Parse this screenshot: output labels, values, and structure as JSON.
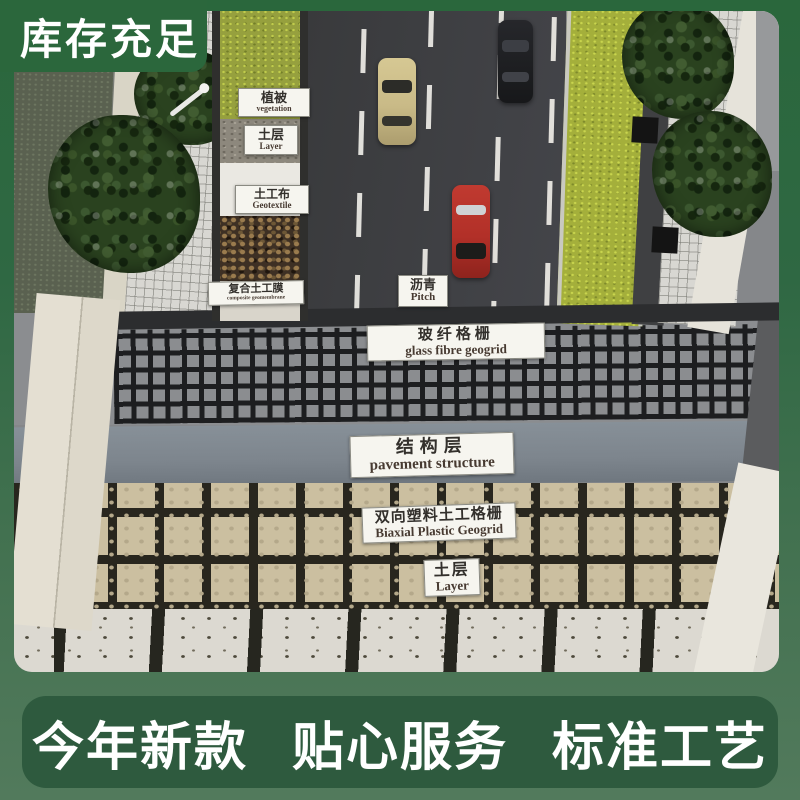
{
  "badge": {
    "label": "库存充足"
  },
  "bottom_banner": {
    "items": [
      "今年新款",
      "贴心服务",
      "标准工艺"
    ]
  },
  "model": {
    "tags": {
      "vegetation": {
        "zh": "植被",
        "en": "vegetation"
      },
      "soil_top": {
        "zh": "土层",
        "en": "Layer"
      },
      "geotextile": {
        "zh": "土工布",
        "en": "Geotextile"
      },
      "geomembrane": {
        "zh": "复合土工膜",
        "en": "composite geomembrane"
      },
      "pitch": {
        "zh": "沥青",
        "en": "Pitch"
      },
      "glass_geogrid": {
        "zh": "玻纤格栅",
        "en": "glass fibre geogrid"
      },
      "structure": {
        "zh": "结构层",
        "en": "pavement structure"
      },
      "biaxial": {
        "zh": "双向塑料土工格栅",
        "en": "Biaxial Plastic Geogrid"
      },
      "soil_bottom": {
        "zh": "土层",
        "en": "Layer"
      }
    }
  },
  "colors": {
    "frame_green_top": "#2a673c",
    "frame_green_bottom": "#527a5c",
    "badge_green": "#2b673c",
    "banner_green": "#2e5a3e",
    "road_asphalt": "#3c3d3f",
    "lane_marking_white": "#e9e7e2",
    "grass_bright": "#a4af3b",
    "geogrid_cell_beige": "#cbbfa0",
    "structure_band_gray": "#7d858d",
    "tag_background": "#f6f5ef",
    "car_yellow": "#c9ba87",
    "car_black": "#1d1e20",
    "car_red": "#b23028"
  }
}
